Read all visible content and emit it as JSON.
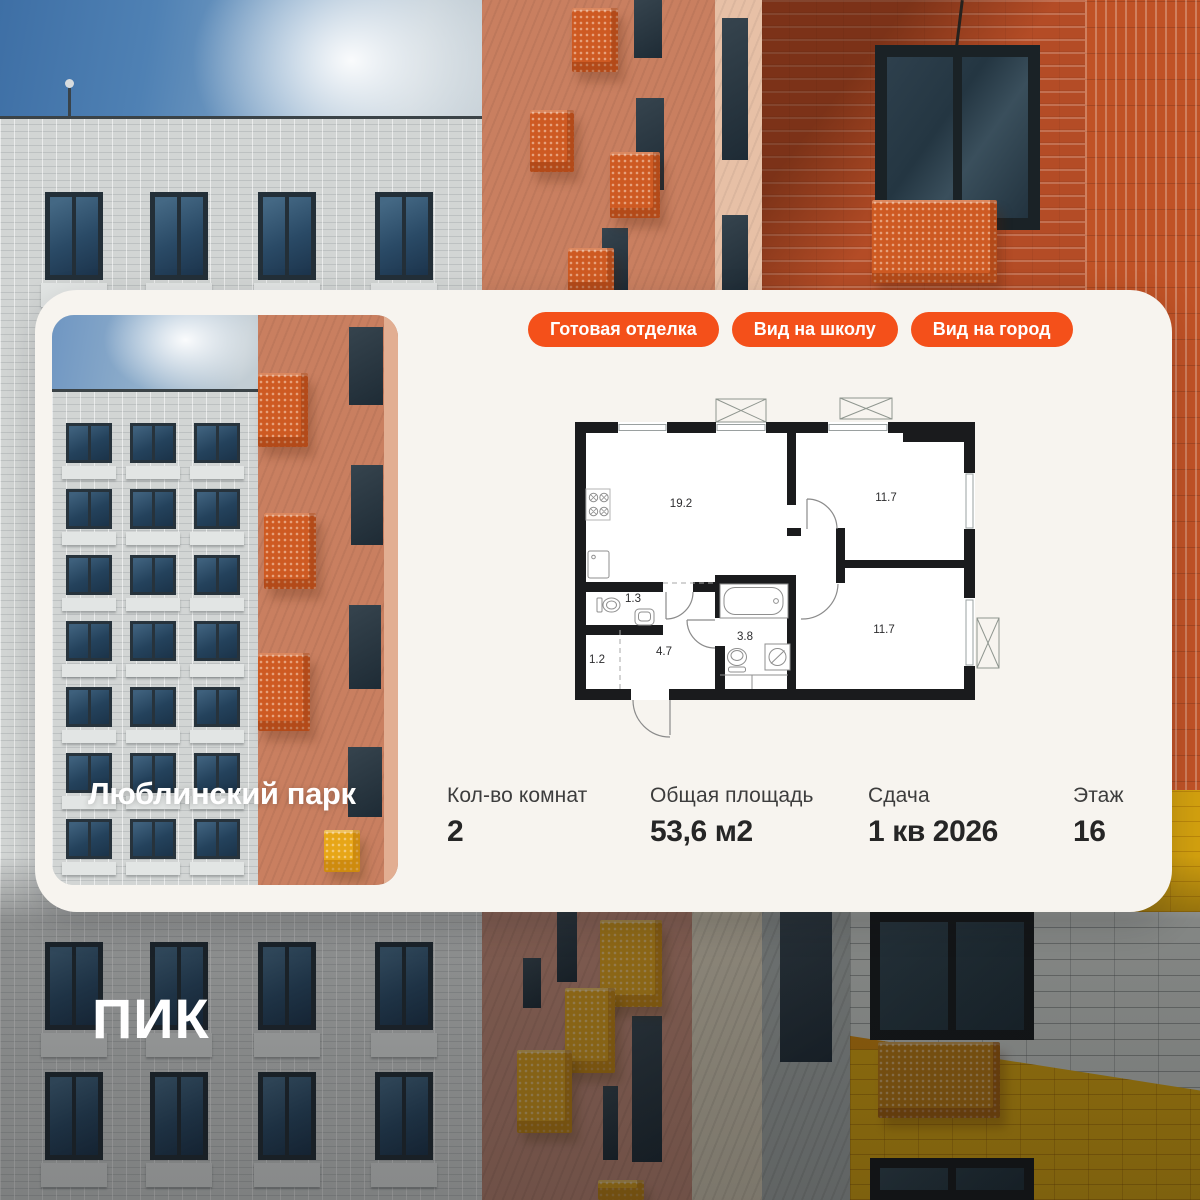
{
  "brand": {
    "logo": "ПИК",
    "accent_color": "#F4501A"
  },
  "card": {
    "badges": [
      "Готовая отделка",
      "Вид на школу",
      "Вид на город"
    ],
    "project_title": "Люблинский парк",
    "floorplan": {
      "room_areas": [
        "19.2",
        "11.7",
        "1.3",
        "3.8",
        "4.7",
        "1.2",
        "11.7"
      ]
    },
    "stats": [
      {
        "label": "Кол-во комнат",
        "value": "2"
      },
      {
        "label": "Общая площадь",
        "value": "53,6 м2"
      },
      {
        "label": "Сдача",
        "value": "1 кв 2026"
      },
      {
        "label": "Этаж",
        "value": "16"
      }
    ]
  }
}
